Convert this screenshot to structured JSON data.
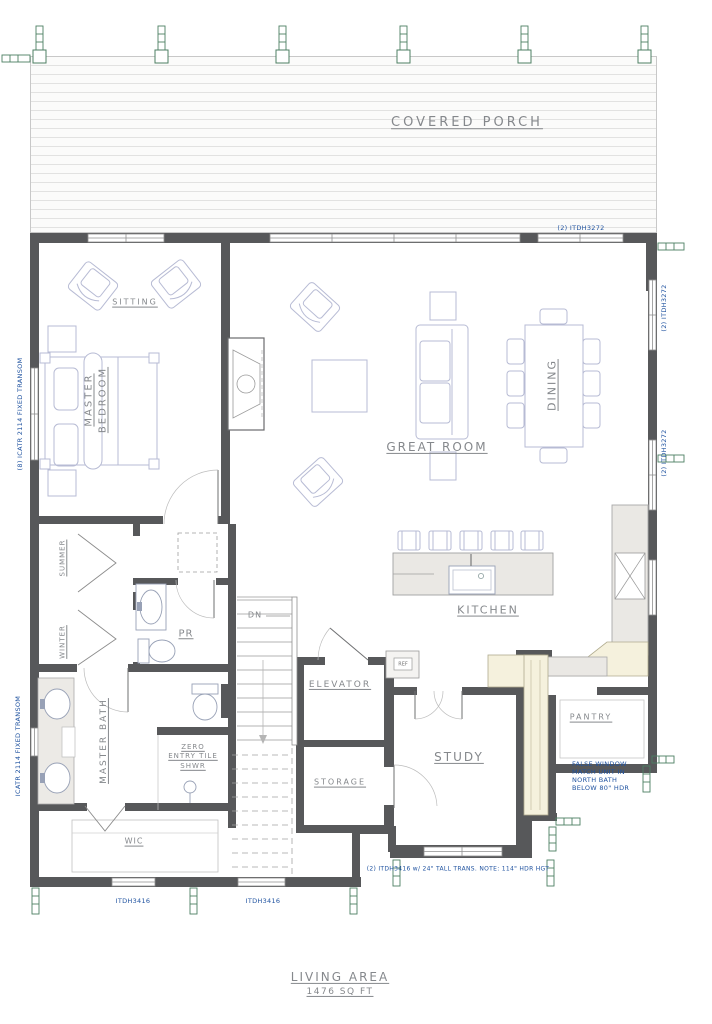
{
  "rooms": {
    "covered_porch": "COVERED PORCH",
    "sitting": "SITTING",
    "master_bedroom": "MASTER BEDROOM",
    "great_room": "GREAT ROOM",
    "dining": "DINING",
    "kitchen": "KITCHEN",
    "powder_room": "PR",
    "summer": "SUMMER",
    "winter": "WINTER",
    "master_bath": "MASTER BATH",
    "shower": "ZERO ENTRY TILE SHWR",
    "elevator": "ELEVATOR",
    "storage": "STORAGE",
    "study": "STUDY",
    "pantry": "PANTRY",
    "wic": "WIC",
    "stairs": "DN",
    "fridge": "REF"
  },
  "annotations": {
    "itdh3272": "(2) ITDH3272",
    "icatr_upper": "(8) ICATR 2114 FIXED TRANSOM",
    "icatr_lower": "ICATR 2114 FIXED TRANSOM",
    "itdh3416": "ITDH3416",
    "study_window_note": "(2) ITDH3416 w/ 24\" TALL TRANS. NOTE: 114\" HDR HGT",
    "false_window_note": "FALSE WINDOW MATCH UNIT IN NORTH BATH BELOW 80\" HDR"
  },
  "footer": {
    "living_area_title": "LIVING AREA",
    "living_area_value": "1476 SQ FT"
  },
  "colors": {
    "wall": "#57585a",
    "annotation_blue": "#2053a0",
    "label_gray": "#85888c",
    "furniture_lavender": "#b7bbd4",
    "marker_green": "#4d7f63",
    "counter_gray": "#eae8e4",
    "counter_cream": "#f5f1dd"
  }
}
